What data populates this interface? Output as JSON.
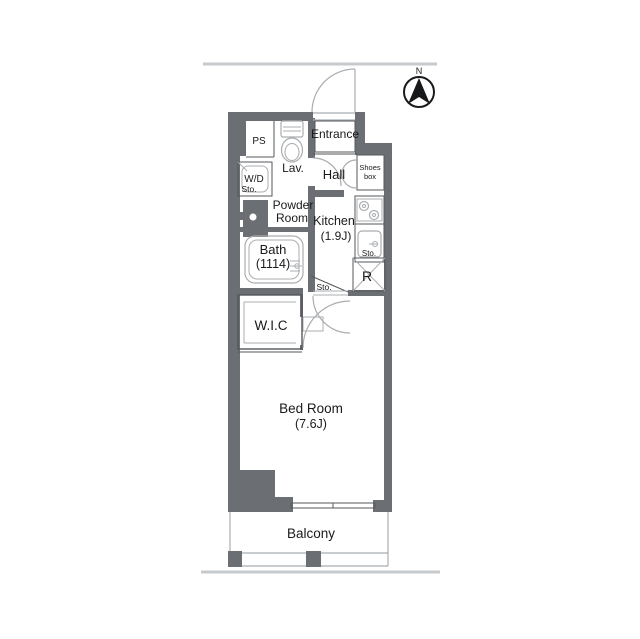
{
  "compass": {
    "north": "N"
  },
  "labels": {
    "entrance": "Entrance",
    "hall": "Hall",
    "shoes_line1": "Shoes",
    "shoes_line2": "box",
    "kitchen_line1": "Kitchen",
    "kitchen_line2": "(1.9J)",
    "kitchen_sto": "Sto.",
    "fridge": "R",
    "ps": "PS",
    "lav": "Lav.",
    "wd_line1": "W/D",
    "wd_line2": "Sto.",
    "powder_line1": "Powder",
    "powder_line2": "Room",
    "bath_line1": "Bath",
    "bath_line2": "(1114)",
    "hall_sto": "Sto.",
    "wic": "W.I.C",
    "bedroom_line1": "Bed Room",
    "bedroom_line2": "(7.6J)",
    "balcony": "Balcony"
  },
  "colors": {
    "wall": "#6b6f73",
    "ink": "#1a1a1a",
    "line": "#54575b",
    "fixture": "#a9adb0",
    "site": "#c6cacc"
  }
}
